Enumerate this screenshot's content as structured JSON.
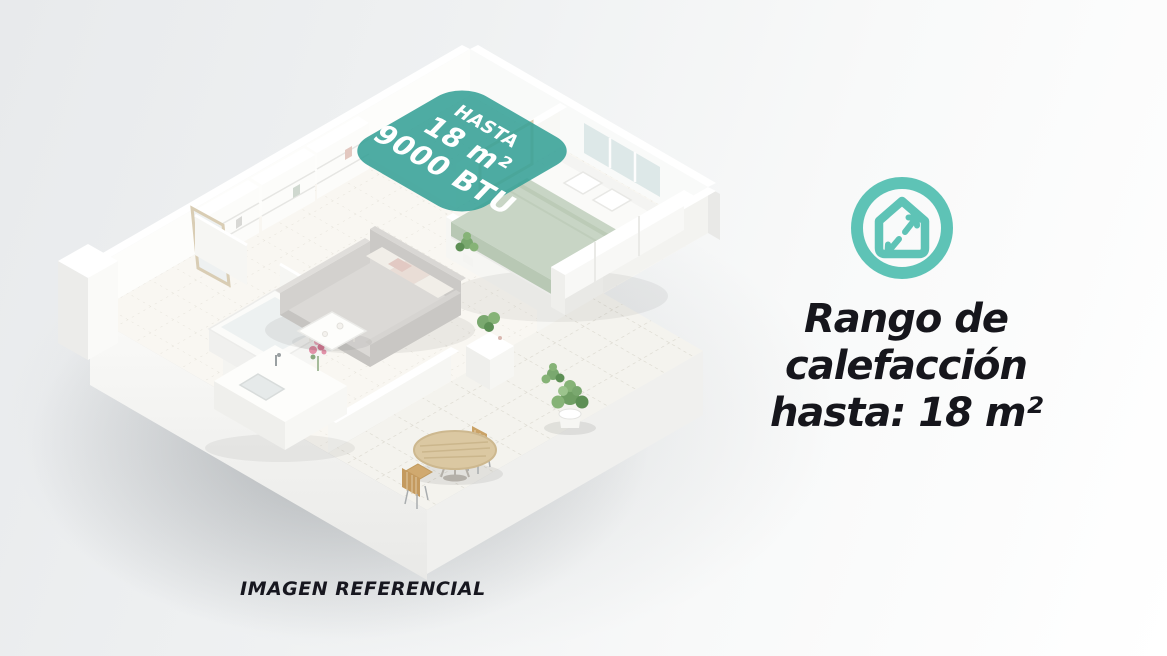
{
  "teal_label": {
    "line1": "HASTA",
    "line2": "18 m²",
    "line3": "9000 BTU"
  },
  "caption": "IMAGEN REFERENCIAL",
  "info": {
    "icon": "house-expand-icon",
    "lines": [
      "Rango de",
      "calefacción",
      "hasta: 18 m²"
    ]
  },
  "colors": {
    "teal_overlay": "#35a096",
    "teal_icon": "#5ec3b6",
    "heading_text": "#16161c",
    "caption_text": "#17171f",
    "blanket_sage": "#c8d5c5",
    "background_start": "#e8eaec",
    "background_end": "#ffffff"
  }
}
